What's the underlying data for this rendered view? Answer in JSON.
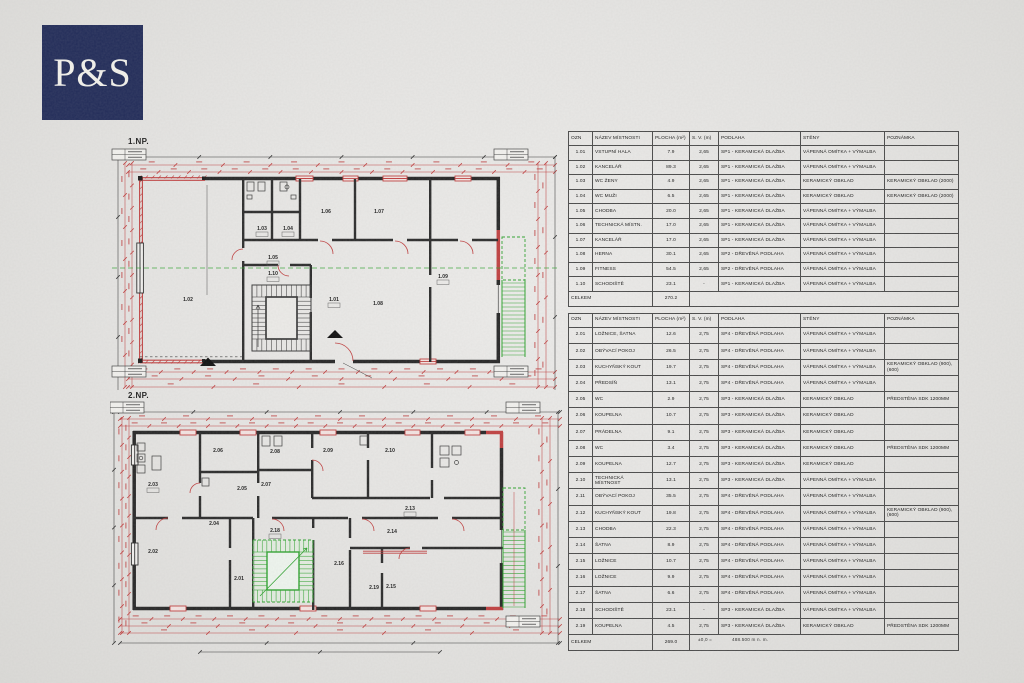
{
  "logo": {
    "text": "P&S",
    "bg_color": "#222c59",
    "fg_color": "#f3f2ec"
  },
  "colors": {
    "dimension_red": "#c04040",
    "drawing_green": "#2fa32f",
    "wall_black": "#262626",
    "paper": "#e6e5e3"
  },
  "plans": [
    {
      "label": "1.NP.",
      "rooms": [
        "1.01",
        "1.02",
        "1.03",
        "1.04",
        "1.05",
        "1.06",
        "1.07",
        "1.08",
        "1.09",
        "1.10"
      ]
    },
    {
      "label": "2.NP.",
      "rooms": [
        "2.01",
        "2.02",
        "2.03",
        "2.04",
        "2.05",
        "2.06",
        "2.07",
        "2.08",
        "2.09",
        "2.10",
        "2.13",
        "2.14",
        "2.15",
        "2.16",
        "2.18",
        "2.19"
      ]
    }
  ],
  "tables": [
    {
      "headers": [
        "OZN",
        "NÁZEV MÍSTNOSTI",
        "PLOCHA (m²)",
        "S. V. (m)",
        "PODLAHA",
        "STĚNY",
        "POZNÁMKA"
      ],
      "rows": [
        [
          "1.01",
          "VSTUPNÍ HALA",
          "7.9",
          "2,65",
          "SP1 - KERAMICKÁ DLAŽBA",
          "VÁPENNÁ OMÍTKA + VÝMALBA",
          ""
        ],
        [
          "1.02",
          "KANCELÁŘ",
          "89.3",
          "2,65",
          "SP1 - KERAMICKÁ DLAŽBA",
          "VÁPENNÁ OMÍTKA + VÝMALBA",
          ""
        ],
        [
          "1.03",
          "WC ŽENY",
          "4.9",
          "2,65",
          "SP1 - KERAMICKÁ DLAŽBA",
          "KERAMICKÝ OBKLAD",
          "KERAMICKÝ OBKLAD (2000)"
        ],
        [
          "1.04",
          "WC MUŽI",
          "6.5",
          "2,65",
          "SP1 - KERAMICKÁ DLAŽBA",
          "KERAMICKÝ OBKLAD",
          "KERAMICKÝ OBKLAD (2000)"
        ],
        [
          "1.05",
          "CHODBA",
          "20.0",
          "2,65",
          "SP1 - KERAMICKÁ DLAŽBA",
          "VÁPENNÁ OMÍTKA + VÝMALBA",
          ""
        ],
        [
          "1.06",
          "TECHNICKÁ MÍSTN.",
          "17.0",
          "2,65",
          "SP1 - KERAMICKÁ DLAŽBA",
          "VÁPENNÁ OMÍTKA + VÝMALBA",
          ""
        ],
        [
          "1.07",
          "KANCELÁŘ",
          "17.0",
          "2,65",
          "SP1 - KERAMICKÁ DLAŽBA",
          "VÁPENNÁ OMÍTKA + VÝMALBA",
          ""
        ],
        [
          "1.08",
          "HERNA",
          "30.1",
          "2,65",
          "SP2 - DŘEVĚNÁ PODLAHA",
          "VÁPENNÁ OMÍTKA + VÝMALBA",
          ""
        ],
        [
          "1.09",
          "FITNESS",
          "54.5",
          "2,65",
          "SP2 - DŘEVĚNÁ PODLAHA",
          "VÁPENNÁ OMÍTKA + VÝMALBA",
          ""
        ],
        [
          "1.10",
          "SCHODIŠTĚ",
          "23.1",
          "-",
          "SP1 - KERAMICKÁ DLAŽBA",
          "VÁPENNÁ OMÍTKA + VÝMALBA",
          ""
        ]
      ],
      "total_label": "CELKEM",
      "total_value": "270.2"
    },
    {
      "headers": [
        "OZN",
        "NÁZEV MÍSTNOSTI",
        "PLOCHA (m²)",
        "S. V. (m)",
        "PODLAHA",
        "STĚNY",
        "POZNÁMKA"
      ],
      "rows": [
        [
          "2.01",
          "LOŽNICE, ŠATNA",
          "12.6",
          "2,75",
          "SP4 - DŘEVĚNÁ PODLAHA",
          "VÁPENNÁ OMÍTKA + VÝMALBA",
          ""
        ],
        [
          "2.02",
          "OBÝVACÍ POKOJ",
          "26.5",
          "2,75",
          "SP4 - DŘEVĚNÁ PODLAHA",
          "VÁPENNÁ OMÍTKA + VÝMALBA",
          ""
        ],
        [
          "2.03",
          "KUCHYŇSKÝ KOUT",
          "19.7",
          "2,75",
          "SP4 - DŘEVĚNÁ PODLAHA",
          "VÁPENNÁ OMÍTKA + VÝMALBA",
          "KERAMICKÝ OBKLAD (900),(600)"
        ],
        [
          "2.04",
          "PŘEDSÍŇ",
          "13.1",
          "2,75",
          "SP4 - DŘEVĚNÁ PODLAHA",
          "VÁPENNÁ OMÍTKA + VÝMALBA",
          ""
        ],
        [
          "2.05",
          "WC",
          "2.9",
          "2,75",
          "SP3 - KERAMICKÁ DLAŽBA",
          "KERAMICKÝ OBKLAD",
          "PŘEDSTĚNA SDK 1200MM"
        ],
        [
          "2.06",
          "KOUPELNA",
          "10.7",
          "2,75",
          "SP3 - KERAMICKÁ DLAŽBA",
          "KERAMICKÝ OBKLAD",
          ""
        ],
        [
          "2.07",
          "PRÁDELNA",
          "9.1",
          "2,75",
          "SP3 - KERAMICKÁ DLAŽBA",
          "KERAMICKÝ OBKLAD",
          ""
        ],
        [
          "2.08",
          "WC",
          "3.4",
          "2,75",
          "SP3 - KERAMICKÁ DLAŽBA",
          "KERAMICKÝ OBKLAD",
          "PŘEDSTĚNA SDK 1200MM"
        ],
        [
          "2.09",
          "KOUPELNA",
          "12.7",
          "2,75",
          "SP3 - KERAMICKÁ DLAŽBA",
          "KERAMICKÝ OBKLAD",
          ""
        ],
        [
          "2.10",
          "TECHNICKÁ MÍSTNOST",
          "13.1",
          "2,75",
          "SP3 - KERAMICKÁ DLAŽBA",
          "VÁPENNÁ OMÍTKA + VÝMALBA",
          ""
        ],
        [
          "2.11",
          "OBÝVACÍ POKOJ",
          "35.5",
          "2,75",
          "SP4 - DŘEVĚNÁ PODLAHA",
          "VÁPENNÁ OMÍTKA + VÝMALBA",
          ""
        ],
        [
          "2.12",
          "KUCHYŇSKÝ KOUT",
          "19.8",
          "2,75",
          "SP4 - DŘEVĚNÁ PODLAHA",
          "VÁPENNÁ OMÍTKA + VÝMALBA",
          "KERAMICKÝ OBKLAD (900),(600)"
        ],
        [
          "2.13",
          "CHODBA",
          "22.3",
          "2,75",
          "SP4 - DŘEVĚNÁ PODLAHA",
          "VÁPENNÁ OMÍTKA + VÝMALBA",
          ""
        ],
        [
          "2.14",
          "ŠATNA",
          "8.9",
          "2,75",
          "SP4 - DŘEVĚNÁ PODLAHA",
          "VÁPENNÁ OMÍTKA + VÝMALBA",
          ""
        ],
        [
          "2.15",
          "LOŽNICE",
          "10.7",
          "2,75",
          "SP4 - DŘEVĚNÁ PODLAHA",
          "VÁPENNÁ OMÍTKA + VÝMALBA",
          ""
        ],
        [
          "2.16",
          "LOŽNICE",
          "9.9",
          "2,75",
          "SP4 - DŘEVĚNÁ PODLAHA",
          "VÁPENNÁ OMÍTKA + VÝMALBA",
          ""
        ],
        [
          "2.17",
          "ŠATNA",
          "6.6",
          "2,75",
          "SP4 - DŘEVĚNÁ PODLAHA",
          "VÁPENNÁ OMÍTKA + VÝMALBA",
          ""
        ],
        [
          "2.18",
          "SCHODIŠTĚ",
          "23.1",
          "-",
          "SP3 - KERAMICKÁ DLAŽBA",
          "VÁPENNÁ OMÍTKA + VÝMALBA",
          ""
        ],
        [
          "2.19",
          "KOUPELNA",
          "4.5",
          "2,75",
          "SP3 - KERAMICKÁ DLAŽBA",
          "KERAMICKÝ OBKLAD",
          "PŘEDSTĚNA SDK 1200MM"
        ]
      ],
      "total_label": "CELKEM",
      "total_value": "269.0"
    }
  ],
  "footnote": {
    "left": "±0,0 =",
    "right": "488.500 m n. m."
  }
}
